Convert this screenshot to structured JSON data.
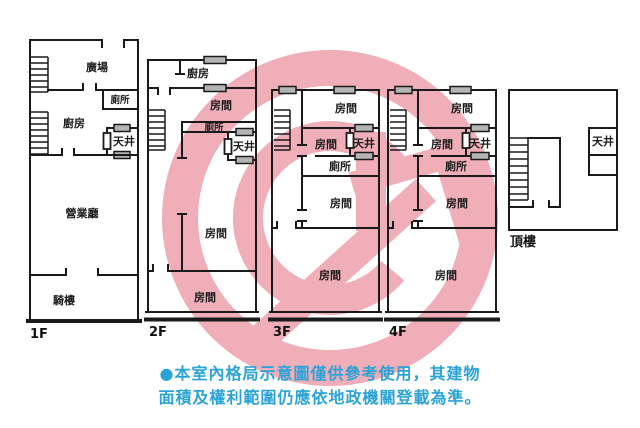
{
  "floors": [
    {
      "label": "1F",
      "rooms": {
        "plaza": "廣場",
        "toilet": "廁所",
        "kitchen": "廚房",
        "lightwell": "天井",
        "business_hall": "營業廳",
        "arcade": "騎樓"
      }
    },
    {
      "label": "2F",
      "rooms": {
        "kitchen": "廚房",
        "room_front": "房間",
        "toilet": "廁所",
        "lightwell": "天井",
        "room_middle": "房間",
        "room_back": "房間"
      }
    },
    {
      "label": "3F",
      "rooms": {
        "room_front": "房間",
        "room_inner": "房間",
        "lightwell": "天井",
        "toilet": "廁所",
        "room_middle": "房間",
        "room_back": "房間"
      }
    },
    {
      "label": "4F",
      "rooms": {
        "room_front": "房間",
        "room_inner": "房間",
        "lightwell": "天井",
        "toilet": "廁所",
        "room_middle": "房間",
        "room_back": "房間"
      }
    },
    {
      "label": "頂樓",
      "rooms": {
        "lightwell": "天井"
      }
    }
  ],
  "disclaimer": {
    "line1": "●本室內格局示意圖僅供參考使用，其建物",
    "line2": "面積及權利範圍仍應依地政機關登載為準。"
  },
  "colors": {
    "watermark_pink": "#efaeb8",
    "wall_black": "#1a1a1a",
    "disclaimer_blue": "#2aa3d6",
    "window_gray": "#b4b4b4"
  }
}
